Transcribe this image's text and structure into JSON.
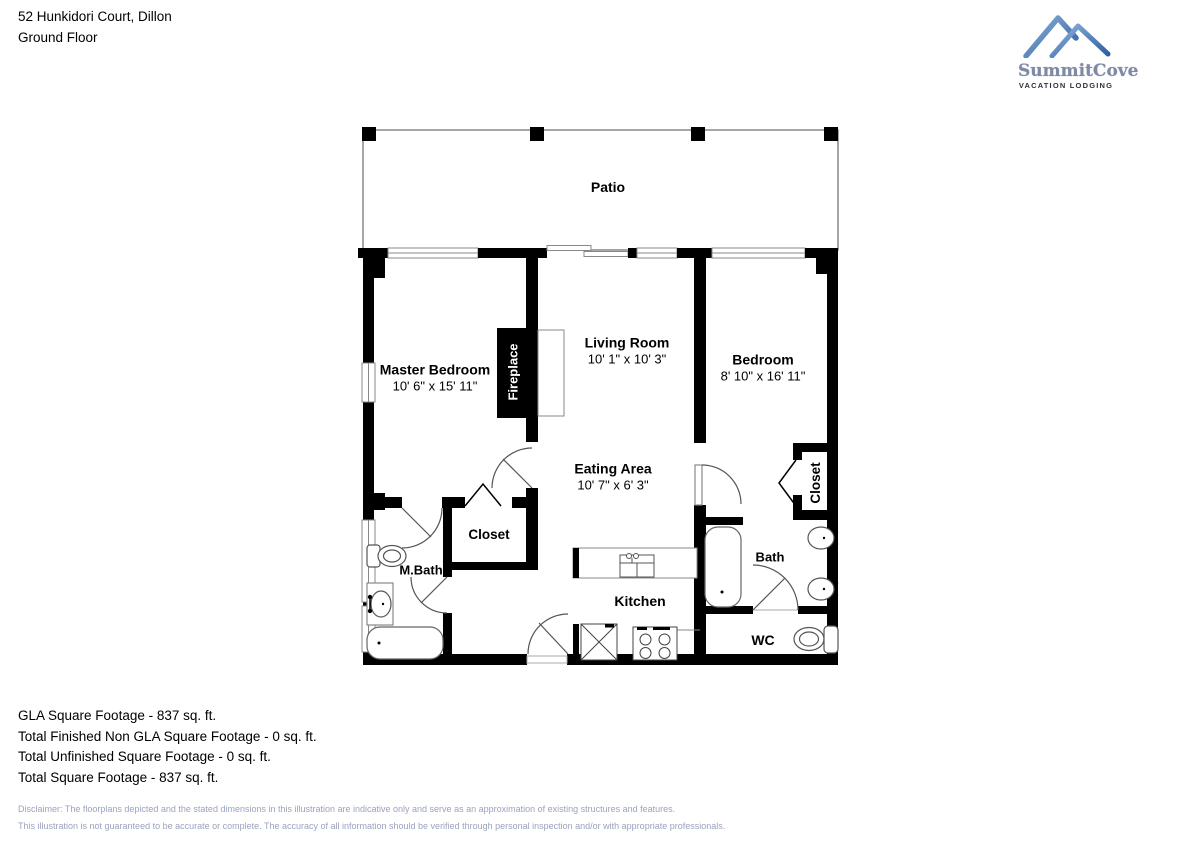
{
  "header": {
    "address": "52 Hunkidori Court, Dillon",
    "floor": "Ground Floor"
  },
  "logo": {
    "name": "SummitCove",
    "tagline": "VACATION LODGING",
    "mountain_blue": "#4677b4"
  },
  "rooms": {
    "patio": {
      "name": "Patio"
    },
    "master_bedroom": {
      "name": "Master Bedroom",
      "dims": "10' 6\" x 15' 11\""
    },
    "living_room": {
      "name": "Living Room",
      "dims": "10' 1\" x 10' 3\""
    },
    "bedroom": {
      "name": "Bedroom",
      "dims": "8' 10\" x 16' 11\""
    },
    "eating_area": {
      "name": "Eating Area",
      "dims": "10' 7\" x 6' 3\""
    },
    "kitchen": {
      "name": "Kitchen"
    },
    "closet_hall": {
      "name": "Closet"
    },
    "closet_bedroom": {
      "name": "Closet"
    },
    "m_bath": {
      "name": "M.Bath"
    },
    "bath": {
      "name": "Bath"
    },
    "wc": {
      "name": "WC"
    },
    "fireplace": {
      "name": "Fireplace"
    }
  },
  "footer": {
    "lines": [
      "GLA Square Footage - 837 sq. ft.",
      "Total Finished Non GLA Square Footage - 0 sq. ft.",
      "Total Unfinished Square Footage - 0 sq. ft.",
      "Total Square Footage - 837 sq. ft."
    ]
  },
  "disclaimer": {
    "line1": "Disclaimer: The floorplans depicted and the stated dimensions in this illustration are indicative only and serve as an approximation of existing structures and features.",
    "line2": "This illustration is not guaranteed to be accurate or complete. The accuracy of all information should be verified through personal inspection and/or with appropriate professionals."
  },
  "colors": {
    "wall": "#000000",
    "thin_line": "#888888",
    "disclaimer_text": "#9aa3bd",
    "logo_text": "#7e89a4"
  }
}
